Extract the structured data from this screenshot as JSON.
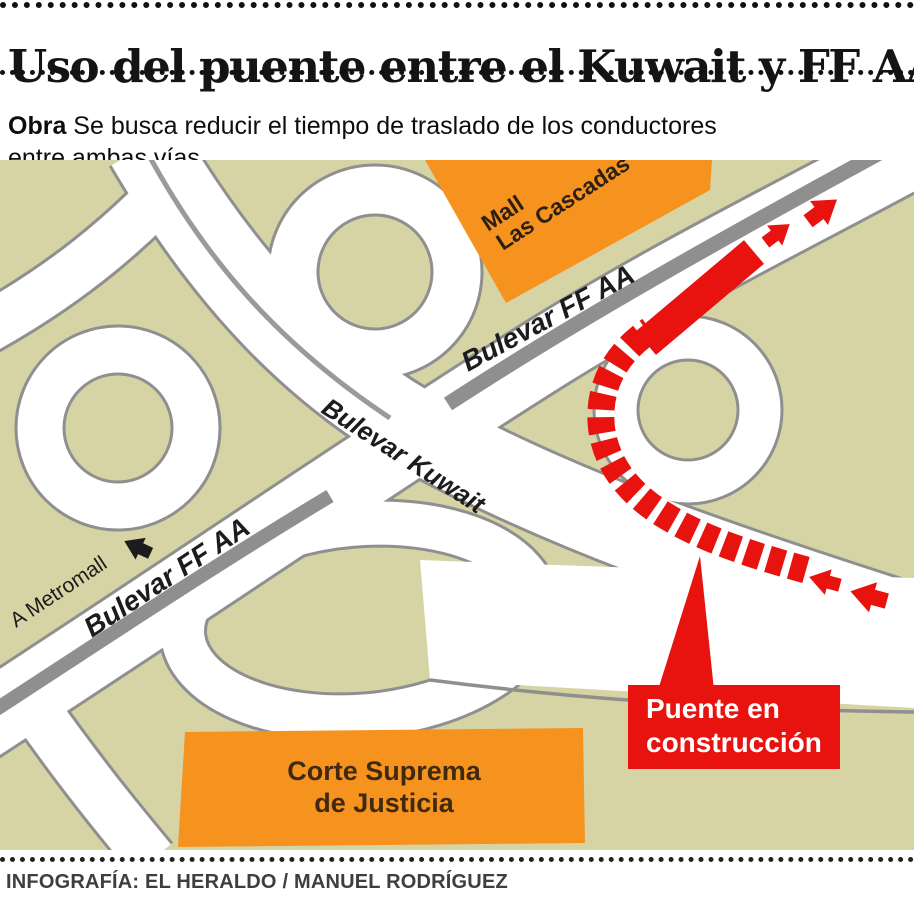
{
  "header": {
    "title": "Uso del puente entre el Kuwait y FF AA",
    "subtitle_bold": "Obra",
    "subtitle_rest": " Se busca reducir el tiempo de traslado de los conductores entre ambas vías"
  },
  "map": {
    "labels": {
      "mall_line1": "Mall",
      "mall_line2": "Las Cascadas",
      "boulevard_ffaa_upper": "Bulevar FF AA",
      "boulevard_ffaa_lower": "Bulevar FF AA",
      "boulevard_kuwait": "Bulevar Kuwait",
      "metromall": "A Metromall",
      "corte_line1": "Corte Suprema",
      "corte_line2": "de Justicia",
      "callout_line1": "Puente en",
      "callout_line2": "construcción"
    },
    "colors": {
      "land": "#d6d3a4",
      "road": "#ffffff",
      "road_casing": "#8f8f8f",
      "median_gray": "#8f8f8f",
      "landmark_orange": "#f6921e",
      "construction_red": "#e8120e",
      "label_ink": "#1c1c1c",
      "block_label_ink": "#3f2a10"
    }
  },
  "footer": {
    "credit": "INFOGRAFÍA: EL HERALDO / MANUEL RODRÍGUEZ"
  }
}
